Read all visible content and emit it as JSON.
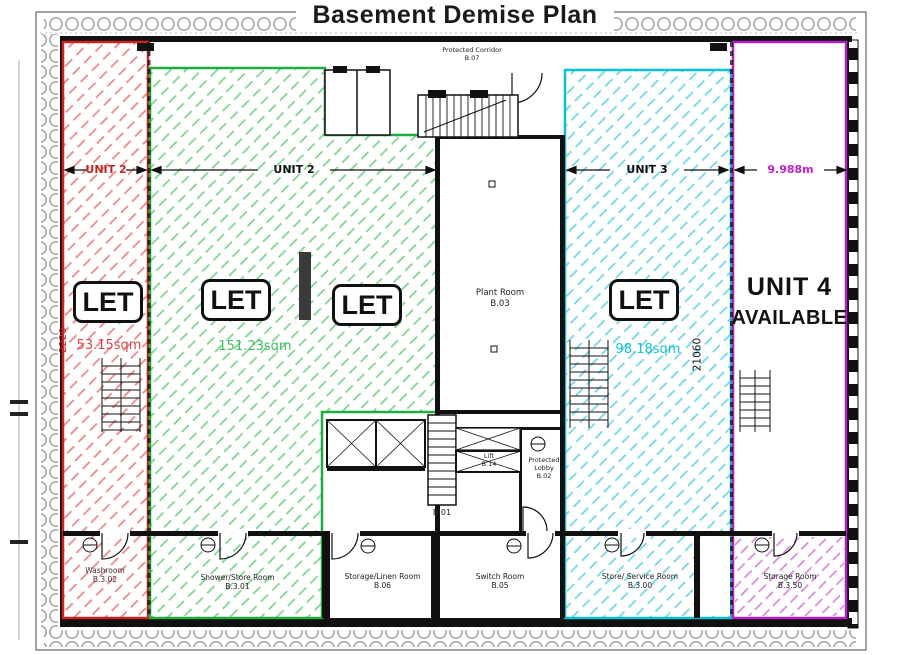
{
  "title": "Basement Demise Plan",
  "colors": {
    "unit2_left": "#cc2222",
    "unit2_main": "#1fae3d",
    "unit3": "#0cc0d4",
    "unit4": "#b21fc4",
    "walls": "#111111"
  },
  "zones": {
    "unit2_left": {
      "dim_label": "UNIT 2",
      "status_badge": "LET",
      "area": "53.15sqm",
      "height_dim": "2220"
    },
    "unit2_main": {
      "dim_label": "UNIT 2",
      "status_badge": "LET",
      "status_badge_2": "LET",
      "area": "151.23sqm"
    },
    "unit3": {
      "dim_label": "UNIT 3",
      "status_badge": "LET",
      "area": "98.18sqm",
      "height_dim": "21060"
    },
    "unit4": {
      "dim_label": "9.988m",
      "name": "UNIT 4",
      "availability": "AVAILABLE"
    }
  },
  "rooms": {
    "protected_corridor": {
      "name": "Protected Corridor",
      "number": "B.07"
    },
    "plant_room": {
      "name": "Plant Room",
      "number": "B.03"
    },
    "stair": {
      "number": "B.01"
    },
    "lift": {
      "name": "Lift",
      "number": "B.14"
    },
    "protected_lobby": {
      "name": "Protected Lobby",
      "number": "B.02"
    },
    "washroom": {
      "name": "Washroom",
      "number": "B.3.02"
    },
    "shower_store": {
      "name": "Shower/Store Room",
      "number": "B.3.01"
    },
    "storage_linen": {
      "name": "Storage/Linen Room",
      "number": "B.06"
    },
    "switch_room": {
      "name": "Switch Room",
      "number": "B.05"
    },
    "store_service": {
      "name": "Store/ Service Room",
      "number": "B.3.00"
    },
    "storage": {
      "name": "Storage Room",
      "number": "B.3.50"
    }
  }
}
